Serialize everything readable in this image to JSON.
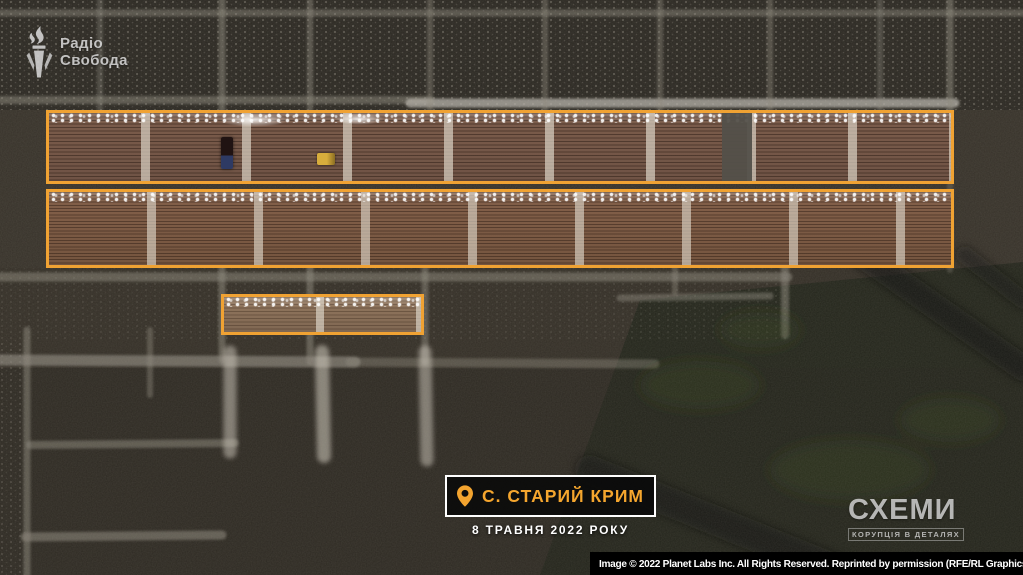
{
  "branding": {
    "radio_liberty": {
      "line1": "Радіо",
      "line2": "Свобода"
    },
    "schemes": {
      "title": "СХЕМИ",
      "tagline": "КОРУПЦІЯ В ДЕТАЛЯХ"
    }
  },
  "location": {
    "pin_label": "С. СТАРИЙ КРИМ",
    "date_label": "8 ТРАВНЯ 2022 РОКУ"
  },
  "attribution": {
    "text": "Image © 2022 Planet Labs Inc. All Rights Reserved. Reprinted by permission (RFE/RL Graphics)"
  },
  "annotations": {
    "highlight_box_count": 3
  },
  "colors": {
    "highlight_box": "#F0A233",
    "location_text": "#F5A62E",
    "location_border": "#FFFFFF",
    "location_bg": "#0A0A0A",
    "attribution_bg": "#000000",
    "attribution_text": "#FFFFFF"
  }
}
